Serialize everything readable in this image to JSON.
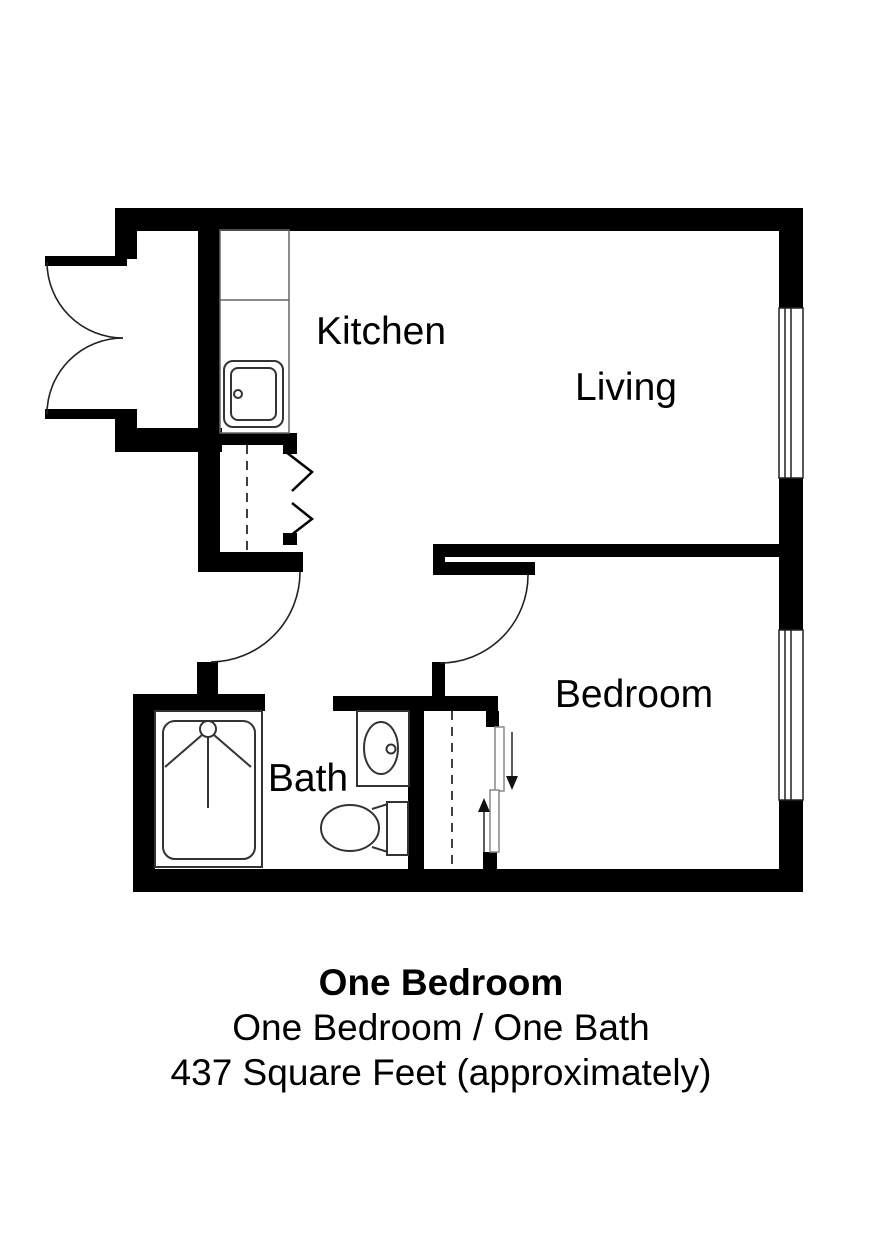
{
  "page": {
    "background": "#ffffff",
    "wall_color": "#000000",
    "fixture_line_color": "#333333"
  },
  "rooms": {
    "kitchen": "Kitchen",
    "living": "Living",
    "bedroom": "Bedroom",
    "bath": "Bath"
  },
  "caption": {
    "line1": "One Bedroom",
    "line2": "One Bedroom / One Bath",
    "line3": "437 Square Feet (approximately)"
  },
  "symbols": {
    "entry": "double-french-door",
    "kitchen": [
      "kitchen-counter",
      "kitchen-sink"
    ],
    "hall": [
      "bifold-closet",
      "swing-door"
    ],
    "bath": [
      "shower",
      "vanity-sink",
      "toilet",
      "swing-door-opening"
    ],
    "bedroom": [
      "sliding-bypass-closet",
      "swing-door",
      "window"
    ],
    "living": [
      "window"
    ]
  }
}
